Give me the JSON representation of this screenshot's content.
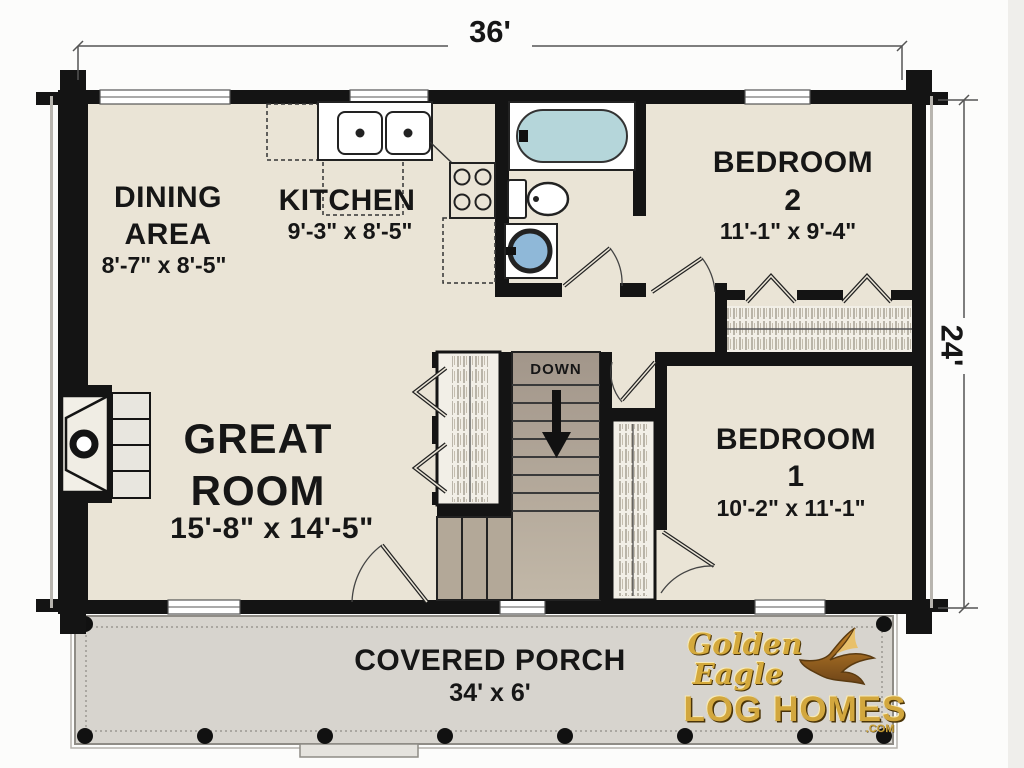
{
  "dimensions": {
    "width_label": "36'",
    "height_label": "24'"
  },
  "rooms": {
    "dining": {
      "name_line1": "DINING",
      "name_line2": "AREA",
      "dims": "8'-7\" x 8'-5\""
    },
    "kitchen": {
      "name": "KITCHEN",
      "dims": "9'-3\" x 8'-5\""
    },
    "bedroom2": {
      "name_line1": "BEDROOM",
      "name_line2": "2",
      "dims": "11'-1\" x 9'-4\""
    },
    "great_room": {
      "name_line1": "GREAT",
      "name_line2": "ROOM",
      "dims": "15'-8\" x 14'-5\""
    },
    "bedroom1": {
      "name_line1": "BEDROOM",
      "name_line2": "1",
      "dims": "10'-2\" x 11'-1\""
    },
    "porch": {
      "name": "COVERED PORCH",
      "dims": "34' x 6'"
    }
  },
  "stairs": {
    "label": "DOWN"
  },
  "logo": {
    "line1": "Golden",
    "line2": "Eagle",
    "line3": "LOG HOMES",
    "suffix": ".COM"
  },
  "colors": {
    "floor": "#eae4d6",
    "porch": "#d7d4ce",
    "stairs_fill": "#a89c8b",
    "tub": "#b5d6da",
    "sink_bowl": "#8fb8d8",
    "wall": "#141414",
    "logo_gold": "#d2a73e"
  }
}
